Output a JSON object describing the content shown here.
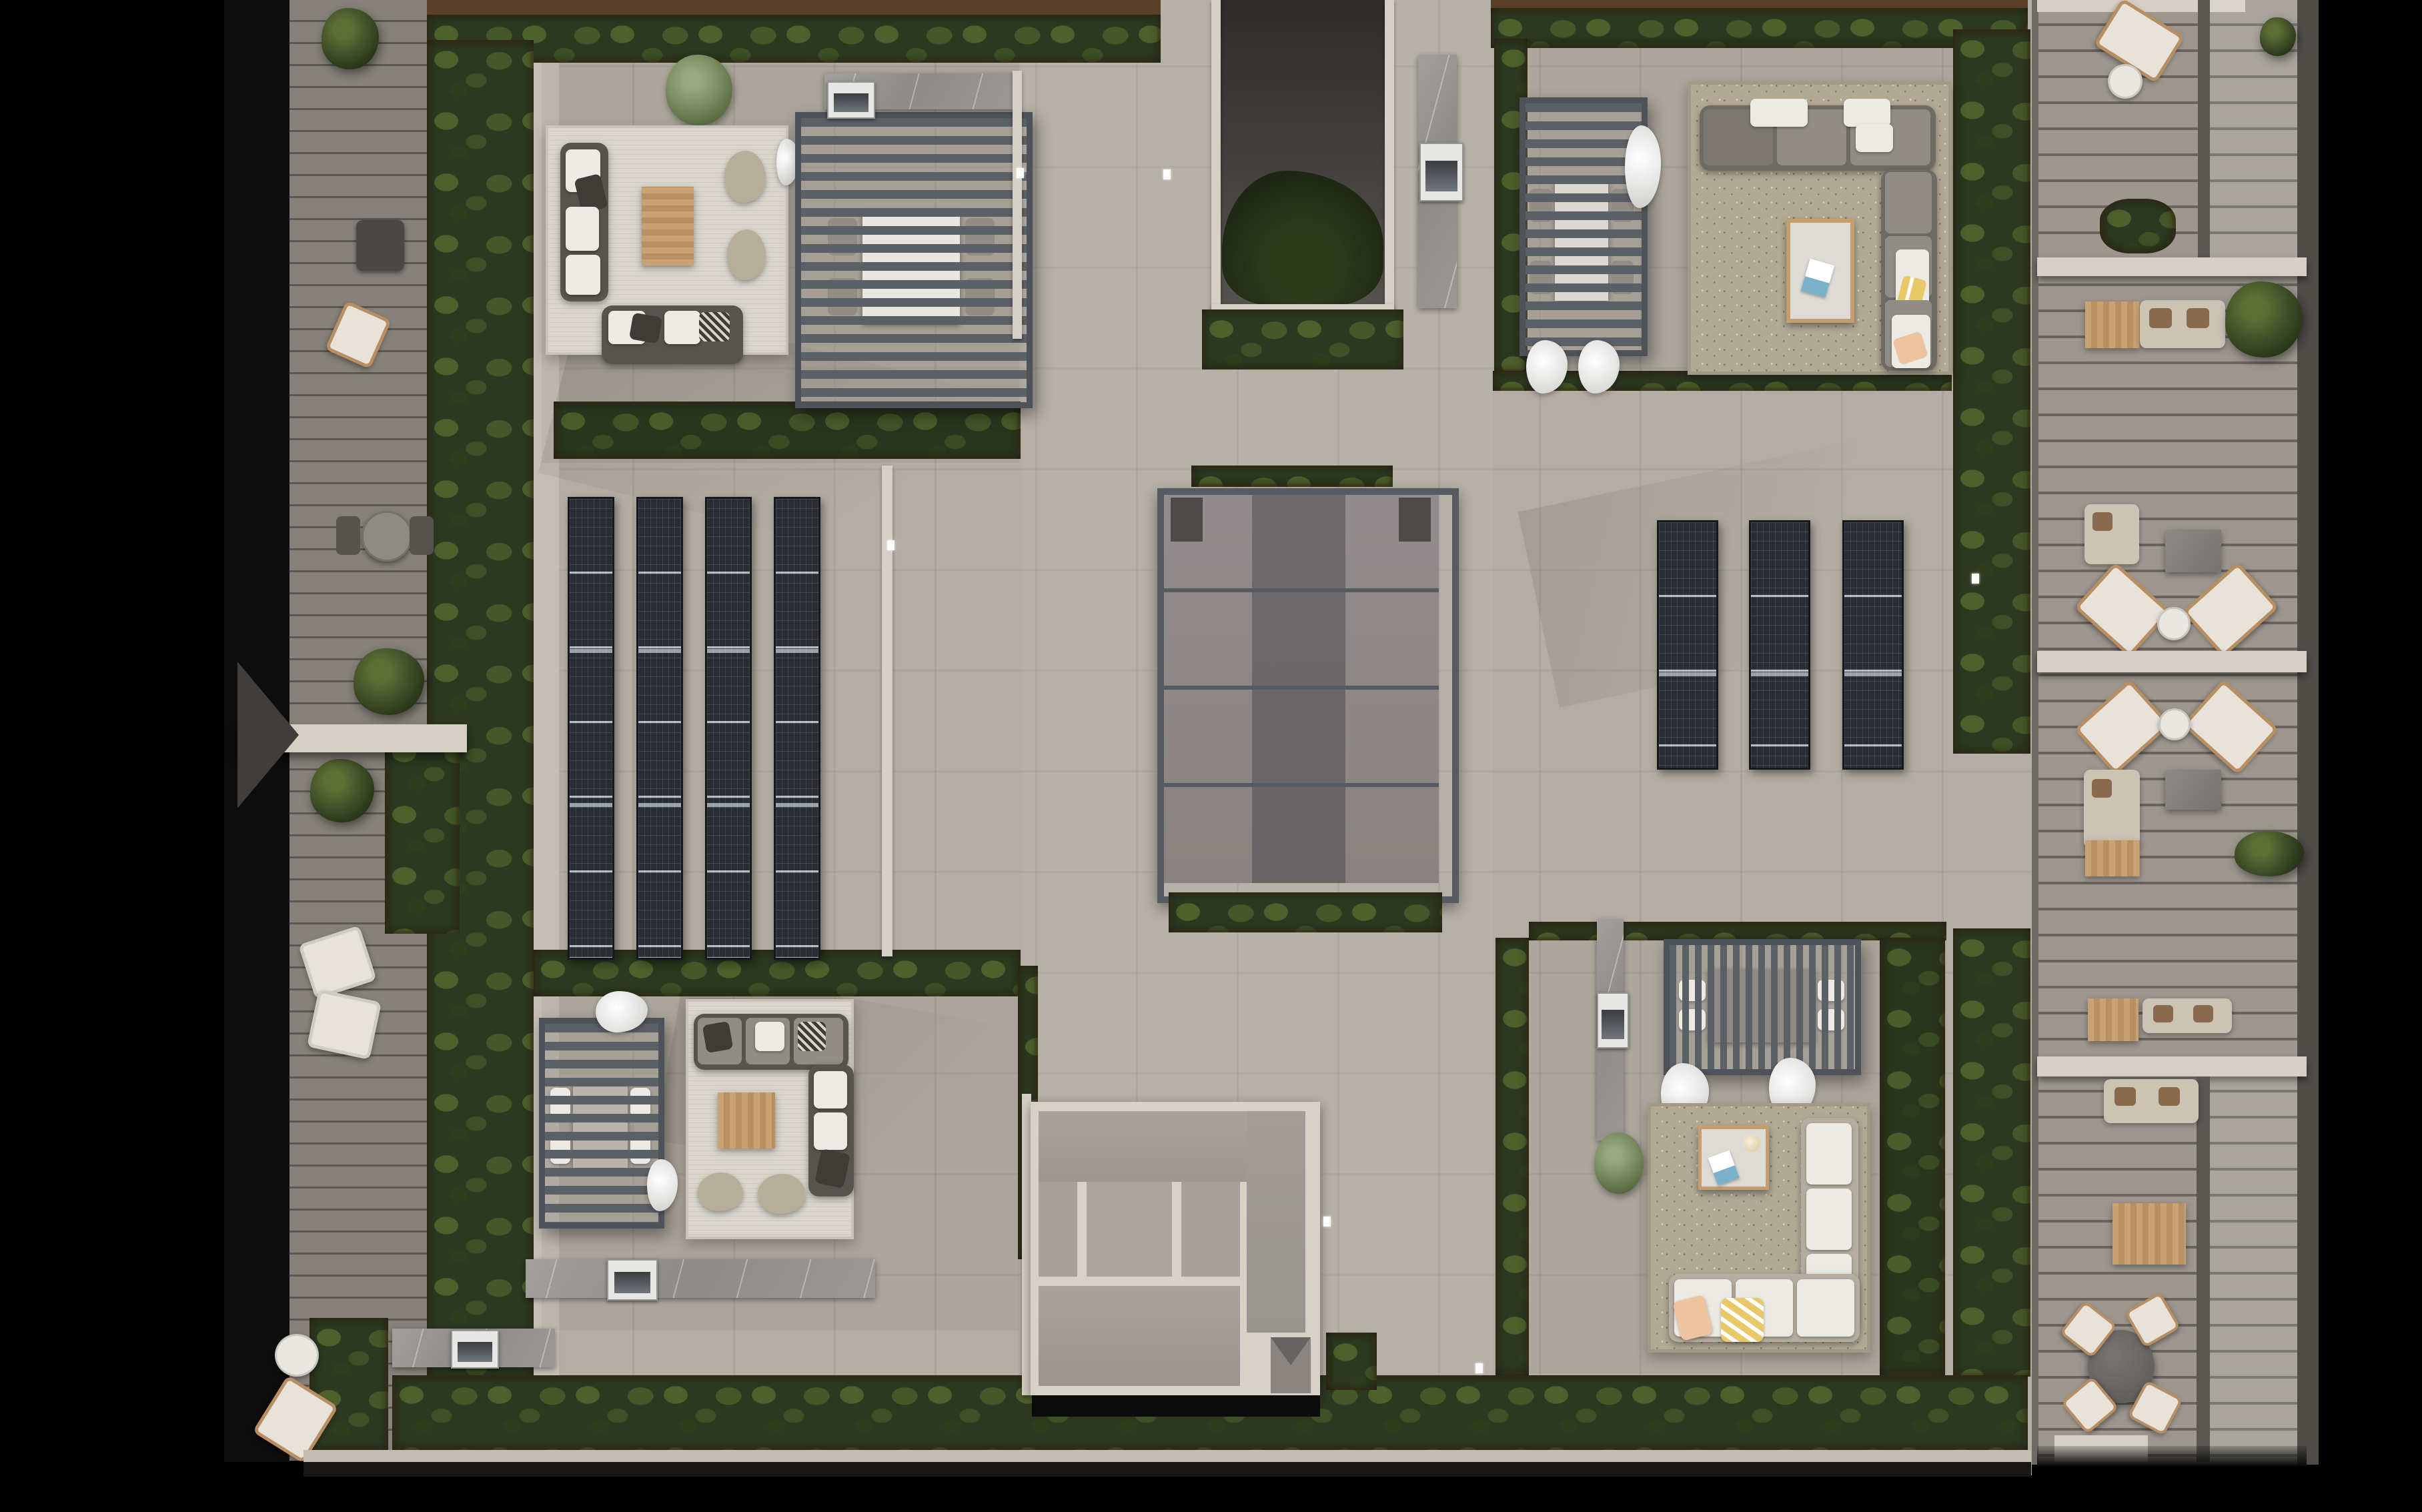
{
  "meta": {
    "title": "Penthouse rooftop plan - photorealistic top-down render",
    "type": "3D architectural roof plan",
    "aria": "Top-down architectural render of a residential rooftop with lounge terraces, pergolas, solar panel arrays, a central skylight, an open light well and a column of private balconies on the right",
    "contains_text": "none"
  },
  "palette": {
    "background": "#000000",
    "paving": "#b3ada3",
    "paving_light": "#c4beb4",
    "deck_left": "#86817a",
    "deck_right": "#9d978f",
    "hedge_green": "#2c3820",
    "soil_brown": "#5a3f28",
    "pergola_slat": "#5b5f66",
    "solar_panel": "#272c32",
    "skylight_frame": "#565b62",
    "skylight_glass_light": "#8e8789",
    "skylight_glass_dark": "#6d6a6b",
    "rug_white": "#d9d5cd",
    "rug_beige": "#b2a995",
    "sofa_gray": "#918c85",
    "sofa_white": "#e9e6e0",
    "wood": "#c49e6c",
    "marble": "#98948f",
    "cream_wall": "#d5cfc6",
    "accent_yellow": "#e9c868",
    "accent_peach": "#eec39f"
  },
  "regions": {
    "left_terrace": {
      "label": "Left wooden-deck terrace with trees, loungers, bistro table and access bridge"
    },
    "top_left_unit": {
      "label": "Top-left roof terrace: white rug lounge with L-sofa, teak coffee table, two ottomans, slatted pergola over dining table and outdoor kitchen with grill"
    },
    "top_right_unit": {
      "label": "Top-right roof terrace: slatted pergola over dining table and beige rug lounge with gray L-sofa and coffee table"
    },
    "bottom_left_unit": {
      "label": "Bottom-left roof terrace: slatted pergola, white rug lounge with L-sofa and ottomans, marble kitchen counter with grill"
    },
    "bottom_right_unit": {
      "label": "Bottom-right roof terrace: vertical-slat pergola over dining table, beige rug with white L-sofa, marble kitchen column with grill"
    },
    "solar_left": {
      "label": "Left photovoltaic array",
      "columns": 4,
      "panels_per_column": 6
    },
    "solar_right": {
      "label": "Right photovoltaic array",
      "columns": 3,
      "panels_per_column": 4
    },
    "skylight": {
      "label": "Central glass skylight",
      "cols": 3,
      "rows": 4
    },
    "atrium": {
      "label": "Open light well with tall tree canopy"
    },
    "stair_house": {
      "label": "Stair and elevator penthouse roof with chute"
    },
    "right_balconies": {
      "label": "Column of stacked private balconies",
      "count": 4
    },
    "hedges": {
      "label": "Perimeter hedge planters with soil borders"
    },
    "lights": {
      "label": "Recessed walkway spotlights",
      "count": 6
    }
  }
}
